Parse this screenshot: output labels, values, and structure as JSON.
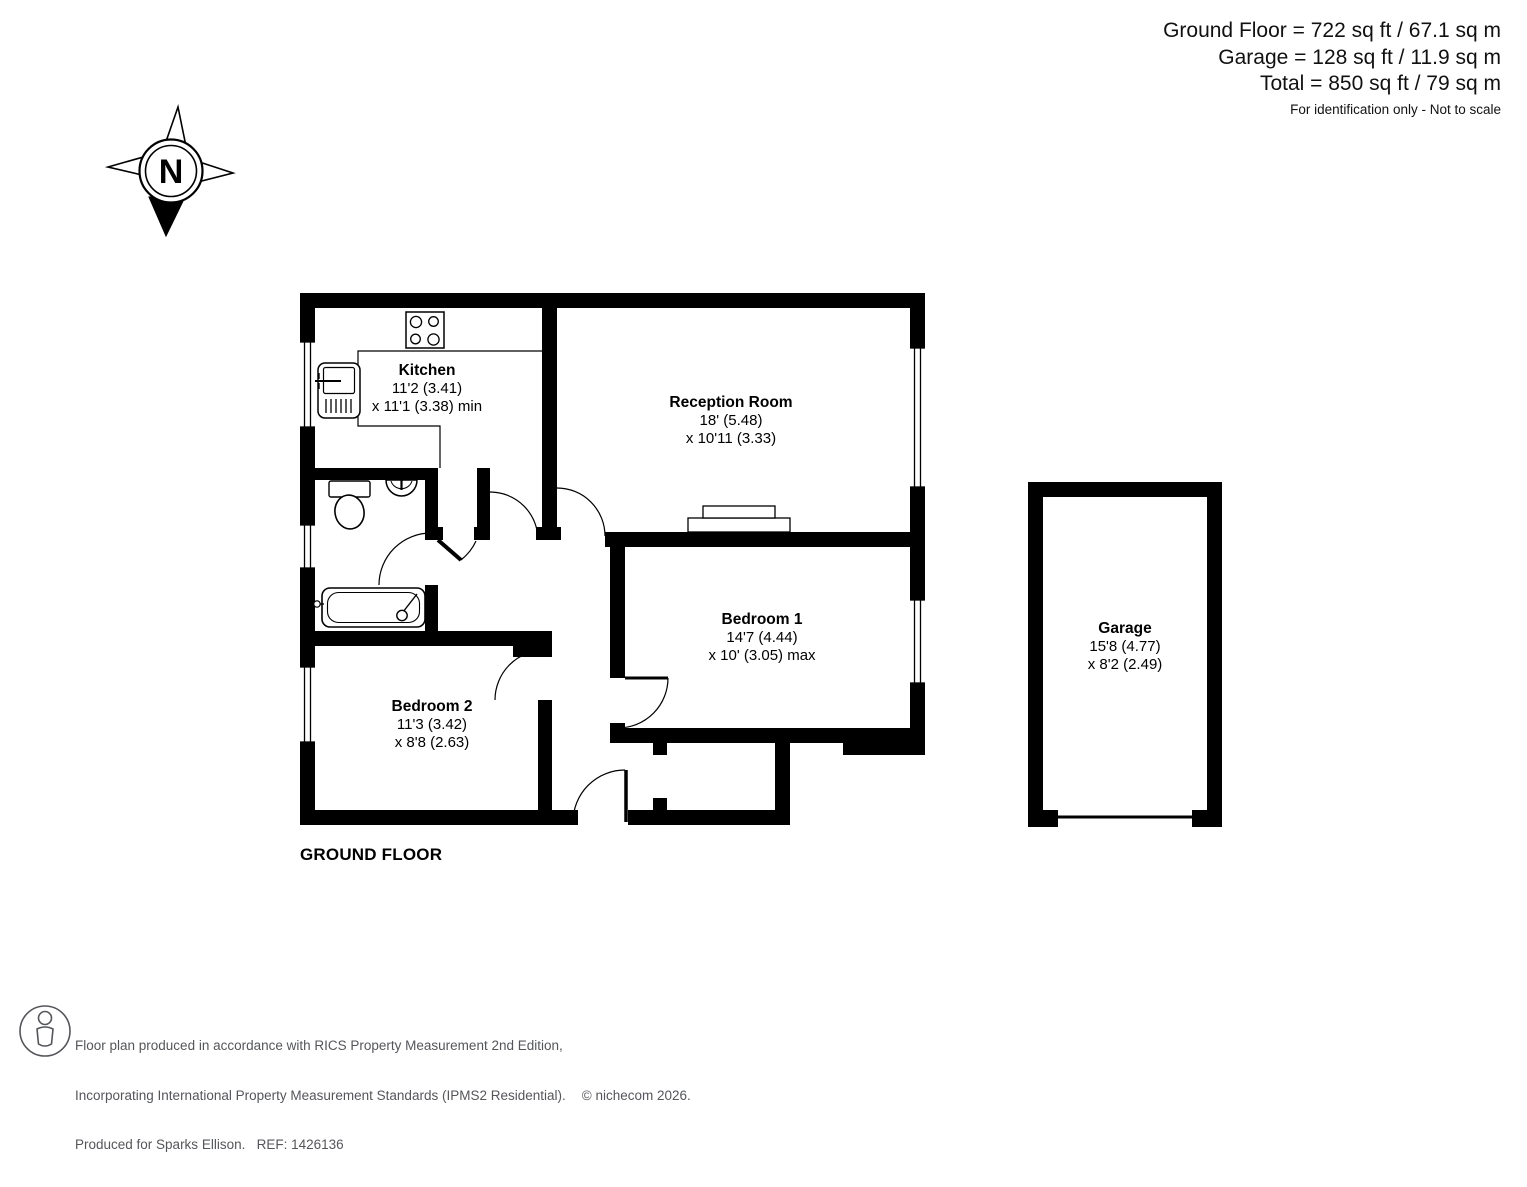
{
  "header": {
    "line1": "Ground Floor = 722 sq ft / 67.1 sq m",
    "line2": "Garage = 128 sq ft / 11.9 sq m",
    "line3": "Total = 850 sq ft / 79 sq m",
    "disclaimer": "For identification only - Not to scale"
  },
  "compass": {
    "label": "N"
  },
  "floor_label": "GROUND FLOOR",
  "rooms": [
    {
      "name": "Kitchen",
      "dim1": "11'2 (3.41)",
      "dim2": "x 11'1 (3.38) min"
    },
    {
      "name": "Reception Room",
      "dim1": "18' (5.48)",
      "dim2": "x 10'11 (3.33)"
    },
    {
      "name": "Bedroom 1",
      "dim1": "14'7 (4.44)",
      "dim2": "x 10' (3.05) max"
    },
    {
      "name": "Bedroom 2",
      "dim1": "11'3 (3.42)",
      "dim2": "x 8'8 (2.63)"
    },
    {
      "name": "Garage",
      "dim1": "15'8 (4.77)",
      "dim2": "x 8'2 (2.49)"
    }
  ],
  "footer": {
    "line1": "Floor plan produced in accordance with RICS Property Measurement 2nd Edition,",
    "line2": "Incorporating International Property Measurement Standards (IPMS2 Residential).",
    "copyright": "© nichecom 2026.",
    "line3": "Produced for Sparks Ellison.   REF: 1426136"
  },
  "colors": {
    "wall": "#000000",
    "background": "#ffffff",
    "footer_text": "#54565a"
  }
}
